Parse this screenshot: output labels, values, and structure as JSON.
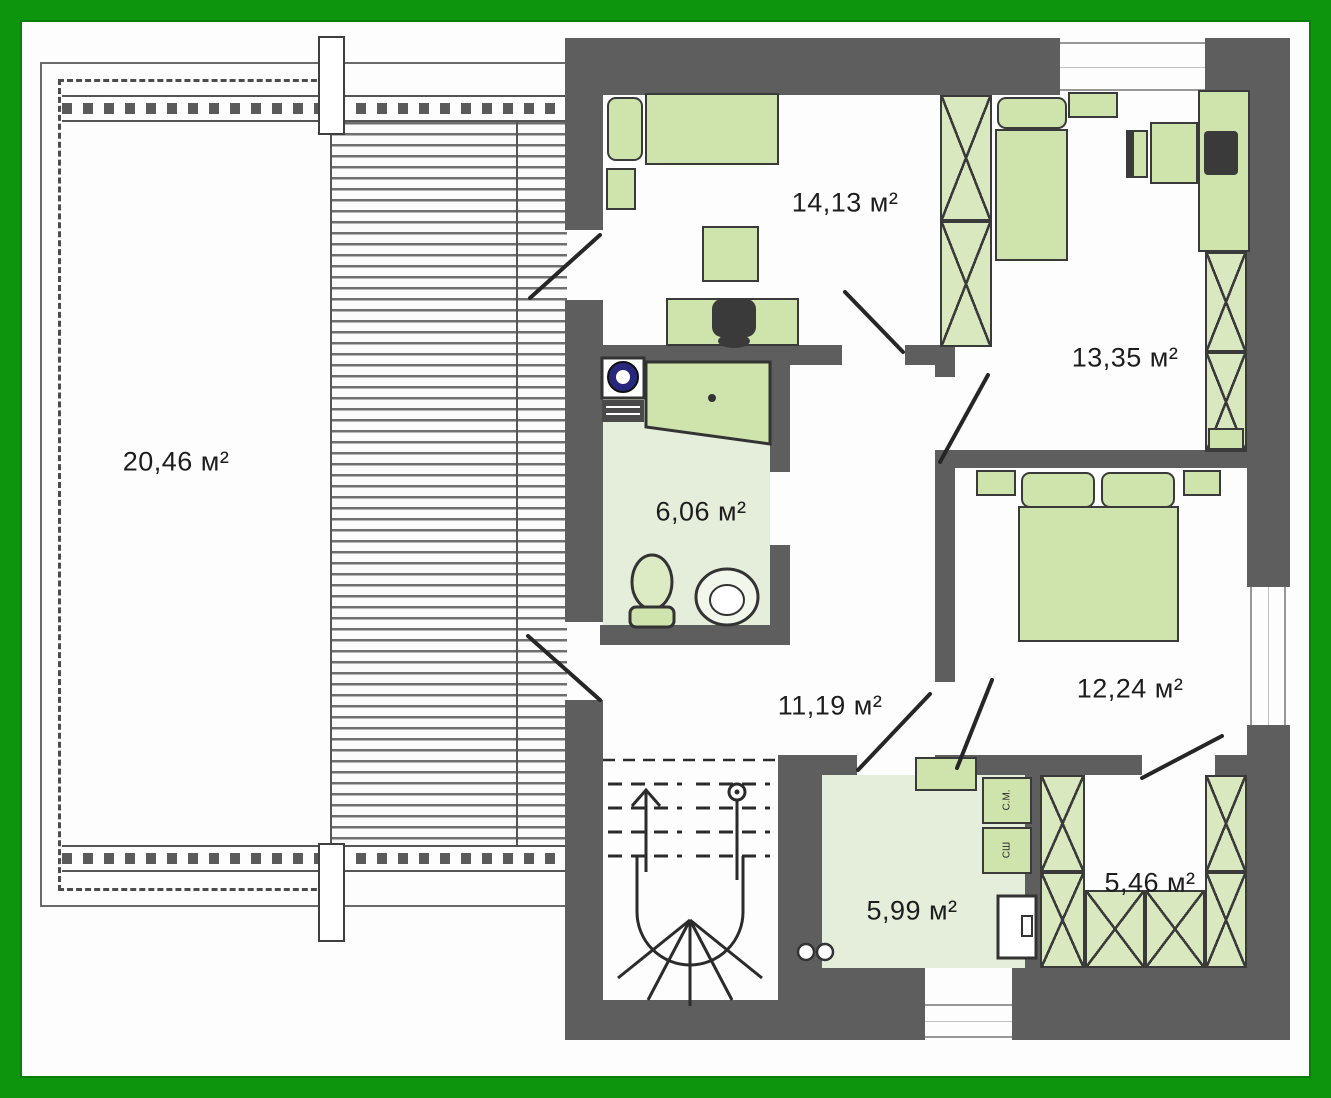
{
  "plan": {
    "rooms": {
      "terrace": {
        "area": "20,46 м²"
      },
      "bedroom_top": {
        "area": "14,13 м²"
      },
      "bedroom_right": {
        "area": "13,35 м²"
      },
      "bathroom": {
        "area": "6,06 м²"
      },
      "hall": {
        "area": "11,19 м²"
      },
      "bedroom_master": {
        "area": "12,24 м²"
      },
      "laundry": {
        "area": "5,99 м²"
      },
      "walkin_wardrobe": {
        "area": "5,46 м²"
      }
    },
    "appliances": {
      "washing_machine": "С.М.",
      "dryer": "СШ"
    },
    "colors": {
      "frame_green": "#0d950d",
      "wall_gray": "#5e5e5e",
      "furniture_green": "#cfe3ad",
      "floor_green": "#e4eeda"
    }
  }
}
